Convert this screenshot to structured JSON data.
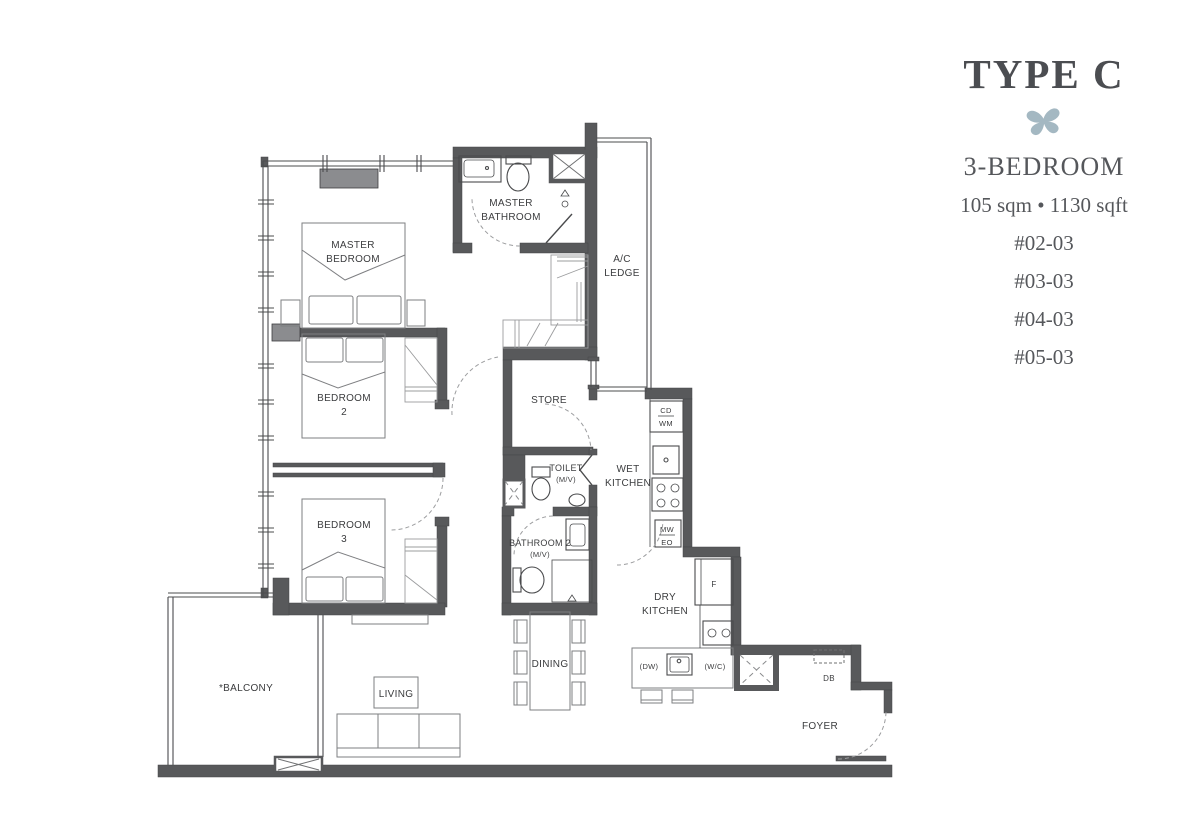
{
  "theme": {
    "wall": "#58595b",
    "planter": "#8b8c8f",
    "accent": "#a4b8c2",
    "text": "#3b3c3e",
    "panel_text": "#55575b",
    "furn": "#7e7f82",
    "fix": "#4a4b4d"
  },
  "panel": {
    "type_title": "TYPE C",
    "bedroom_type": "3-BEDROOM",
    "area": "105 sqm • 1130 sqft",
    "units": [
      "#02-03",
      "#03-03",
      "#04-03",
      "#05-03"
    ]
  },
  "rooms": {
    "master_bedroom": {
      "l1": "MASTER",
      "l2": "BEDROOM"
    },
    "master_bathroom": {
      "l1": "MASTER",
      "l2": "BATHROOM"
    },
    "ac_ledge": {
      "l1": "A/C",
      "l2": "LEDGE"
    },
    "bedroom2": {
      "l1": "BEDROOM",
      "l2": "2"
    },
    "bedroom3": {
      "l1": "BEDROOM",
      "l2": "3"
    },
    "store": {
      "l1": "STORE"
    },
    "toilet": {
      "l1": "TOILET",
      "l2": "(M/V)"
    },
    "wet_kitchen": {
      "l1": "WET",
      "l2": "KITCHEN"
    },
    "bathroom2": {
      "l1": "BATHROOM 2",
      "l2": "(M/V)"
    },
    "dry_kitchen": {
      "l1": "DRY",
      "l2": "KITCHEN"
    },
    "dining": {
      "l1": "DINING"
    },
    "living": {
      "l1": "LIVING"
    },
    "balcony": {
      "l1": "*BALCONY"
    },
    "foyer": {
      "l1": "FOYER"
    }
  },
  "appliances": {
    "cd": "CD",
    "wm": "WM",
    "mw": "MW",
    "eo": "EO",
    "fridge": "F",
    "dishwasher": "(DW)",
    "wc": "(W/C)",
    "db": "DB"
  }
}
